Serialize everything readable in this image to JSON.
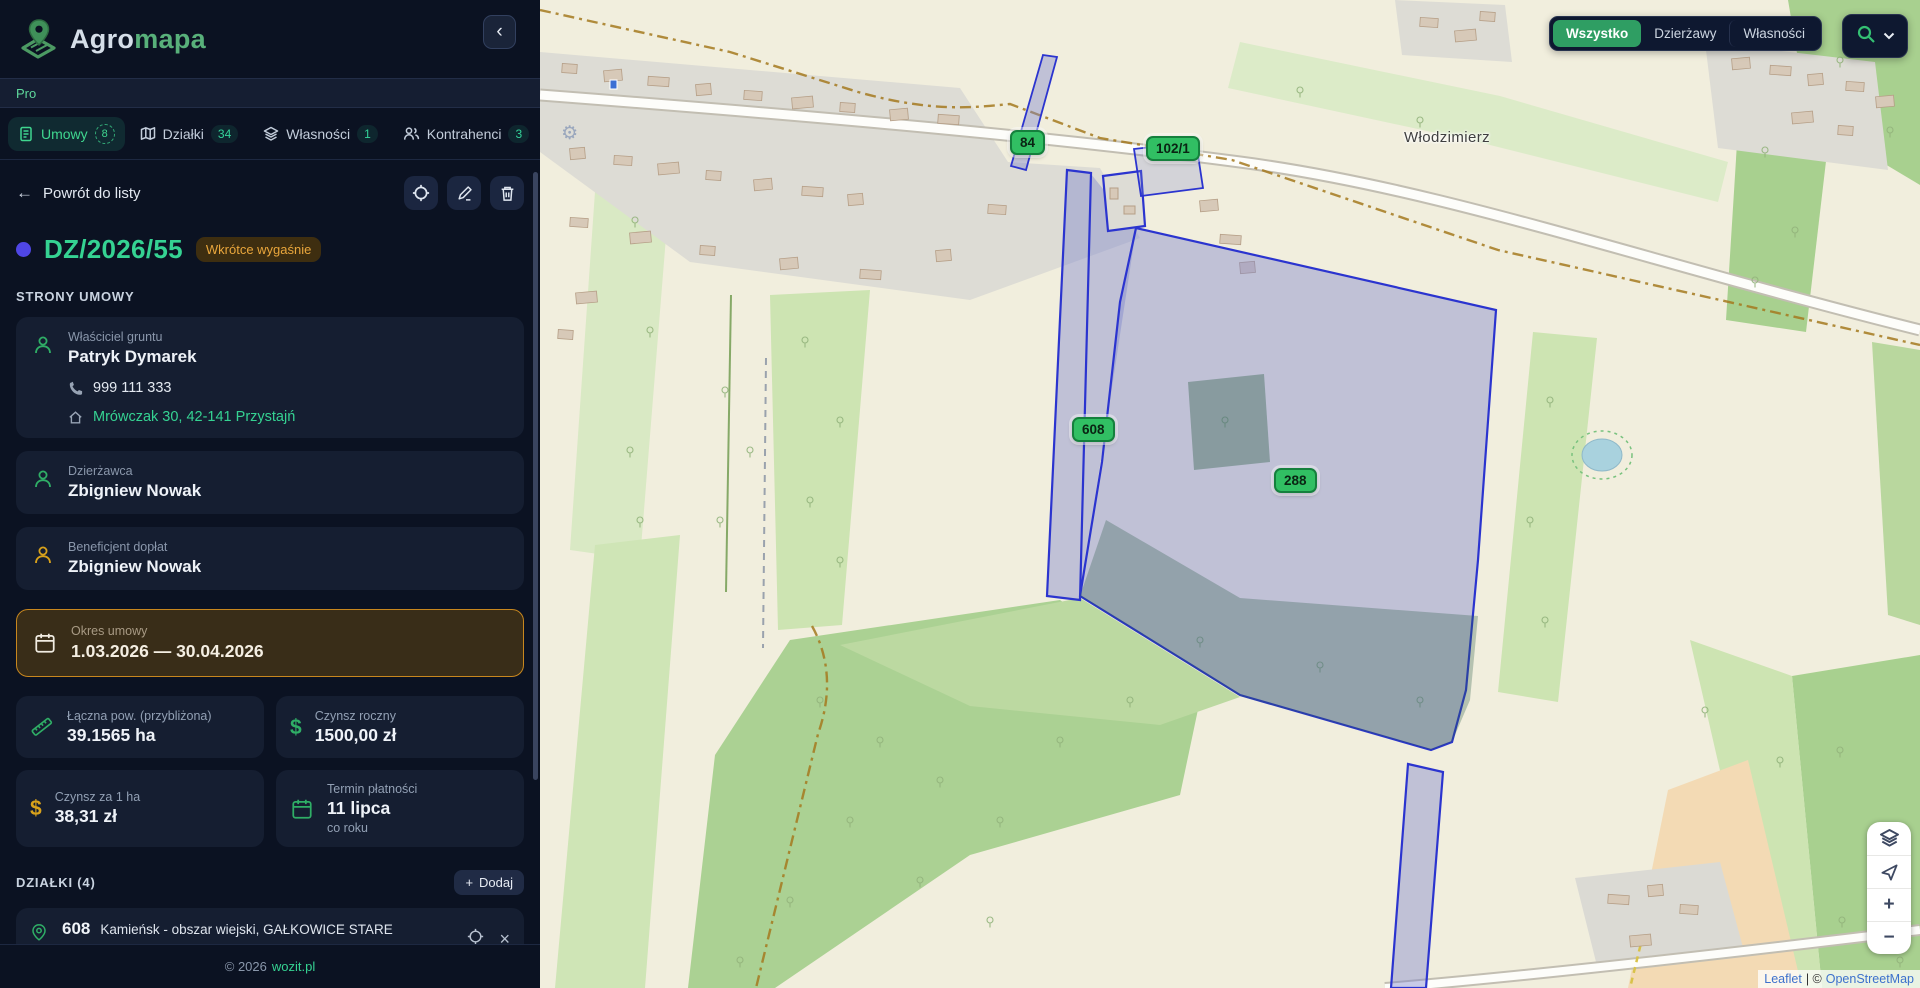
{
  "brand": {
    "agro": "Agro",
    "mapa": "mapa",
    "plan": "Pro"
  },
  "icons": {
    "collapse": "‹",
    "gear": "⚙",
    "close": "×",
    "back_arrow": "←"
  },
  "tabs": [
    {
      "label": "Umowy",
      "count": "8"
    },
    {
      "label": "Działki",
      "count": "34"
    },
    {
      "label": "Własności",
      "count": "1"
    },
    {
      "label": "Kontrahenci",
      "count": "3"
    }
  ],
  "detail": {
    "back_label": "Powrót do listy",
    "contract_id": "DZ/2026/55",
    "status_badge": "Wkrótce wygaśnie",
    "parties_header": "STRONY UMOWY",
    "parties": [
      {
        "role": "Właściciel gruntu",
        "name": "Patryk Dymarek",
        "phone": "999 111 333",
        "address": "Mrówczak 30, 42-141 Przystajń"
      },
      {
        "role": "Dzierżawca",
        "name": "Zbigniew Nowak"
      },
      {
        "role": "Beneficjent dopłat",
        "name": "Zbigniew Nowak"
      }
    ],
    "period": {
      "label": "Okres umowy",
      "value": "1.03.2026 — 30.04.2026"
    },
    "stats": [
      {
        "label": "Łączna pow. (przybliżona)",
        "value": "39.1565 ha"
      },
      {
        "label": "Czynsz roczny",
        "value": "1500,00 zł"
      },
      {
        "label": "Czynsz za 1 ha",
        "value": "38,31 zł"
      },
      {
        "label": "Termin płatności",
        "value": "11 lipca",
        "sub": "co roku"
      }
    ],
    "parcels_header": "DZIAŁKI (4)",
    "add_button": {
      "plus": "+",
      "label": "Dodaj"
    },
    "parcel_item": {
      "number": "608",
      "name": "Kamieńsk - obszar wiejski, GAŁKOWICE STARE",
      "area": "~3.1314 ha"
    }
  },
  "footer": {
    "copyright": "© 2026",
    "link": "wozit.pl"
  },
  "map": {
    "filters": [
      {
        "label": "Wszystko"
      },
      {
        "label": "Dzierżawy"
      },
      {
        "label": "Własności"
      }
    ],
    "place_label": "Włodzimierz",
    "markers": [
      {
        "label": "84"
      },
      {
        "label": "102/1"
      },
      {
        "label": "608"
      },
      {
        "label": "288"
      }
    ],
    "controls": {
      "zoom_in": "+",
      "zoom_out": "−"
    },
    "attribution": {
      "leaflet": "Leaflet",
      "divider": "| ©",
      "osm": "OpenStreetMap"
    }
  },
  "colors": {
    "accent_green": "#34d399",
    "accent_amber": "#d9a21b",
    "marker_green": "#31bf63",
    "parcel_blue": "#2b34cf",
    "status_amber": "#e9a63c"
  }
}
